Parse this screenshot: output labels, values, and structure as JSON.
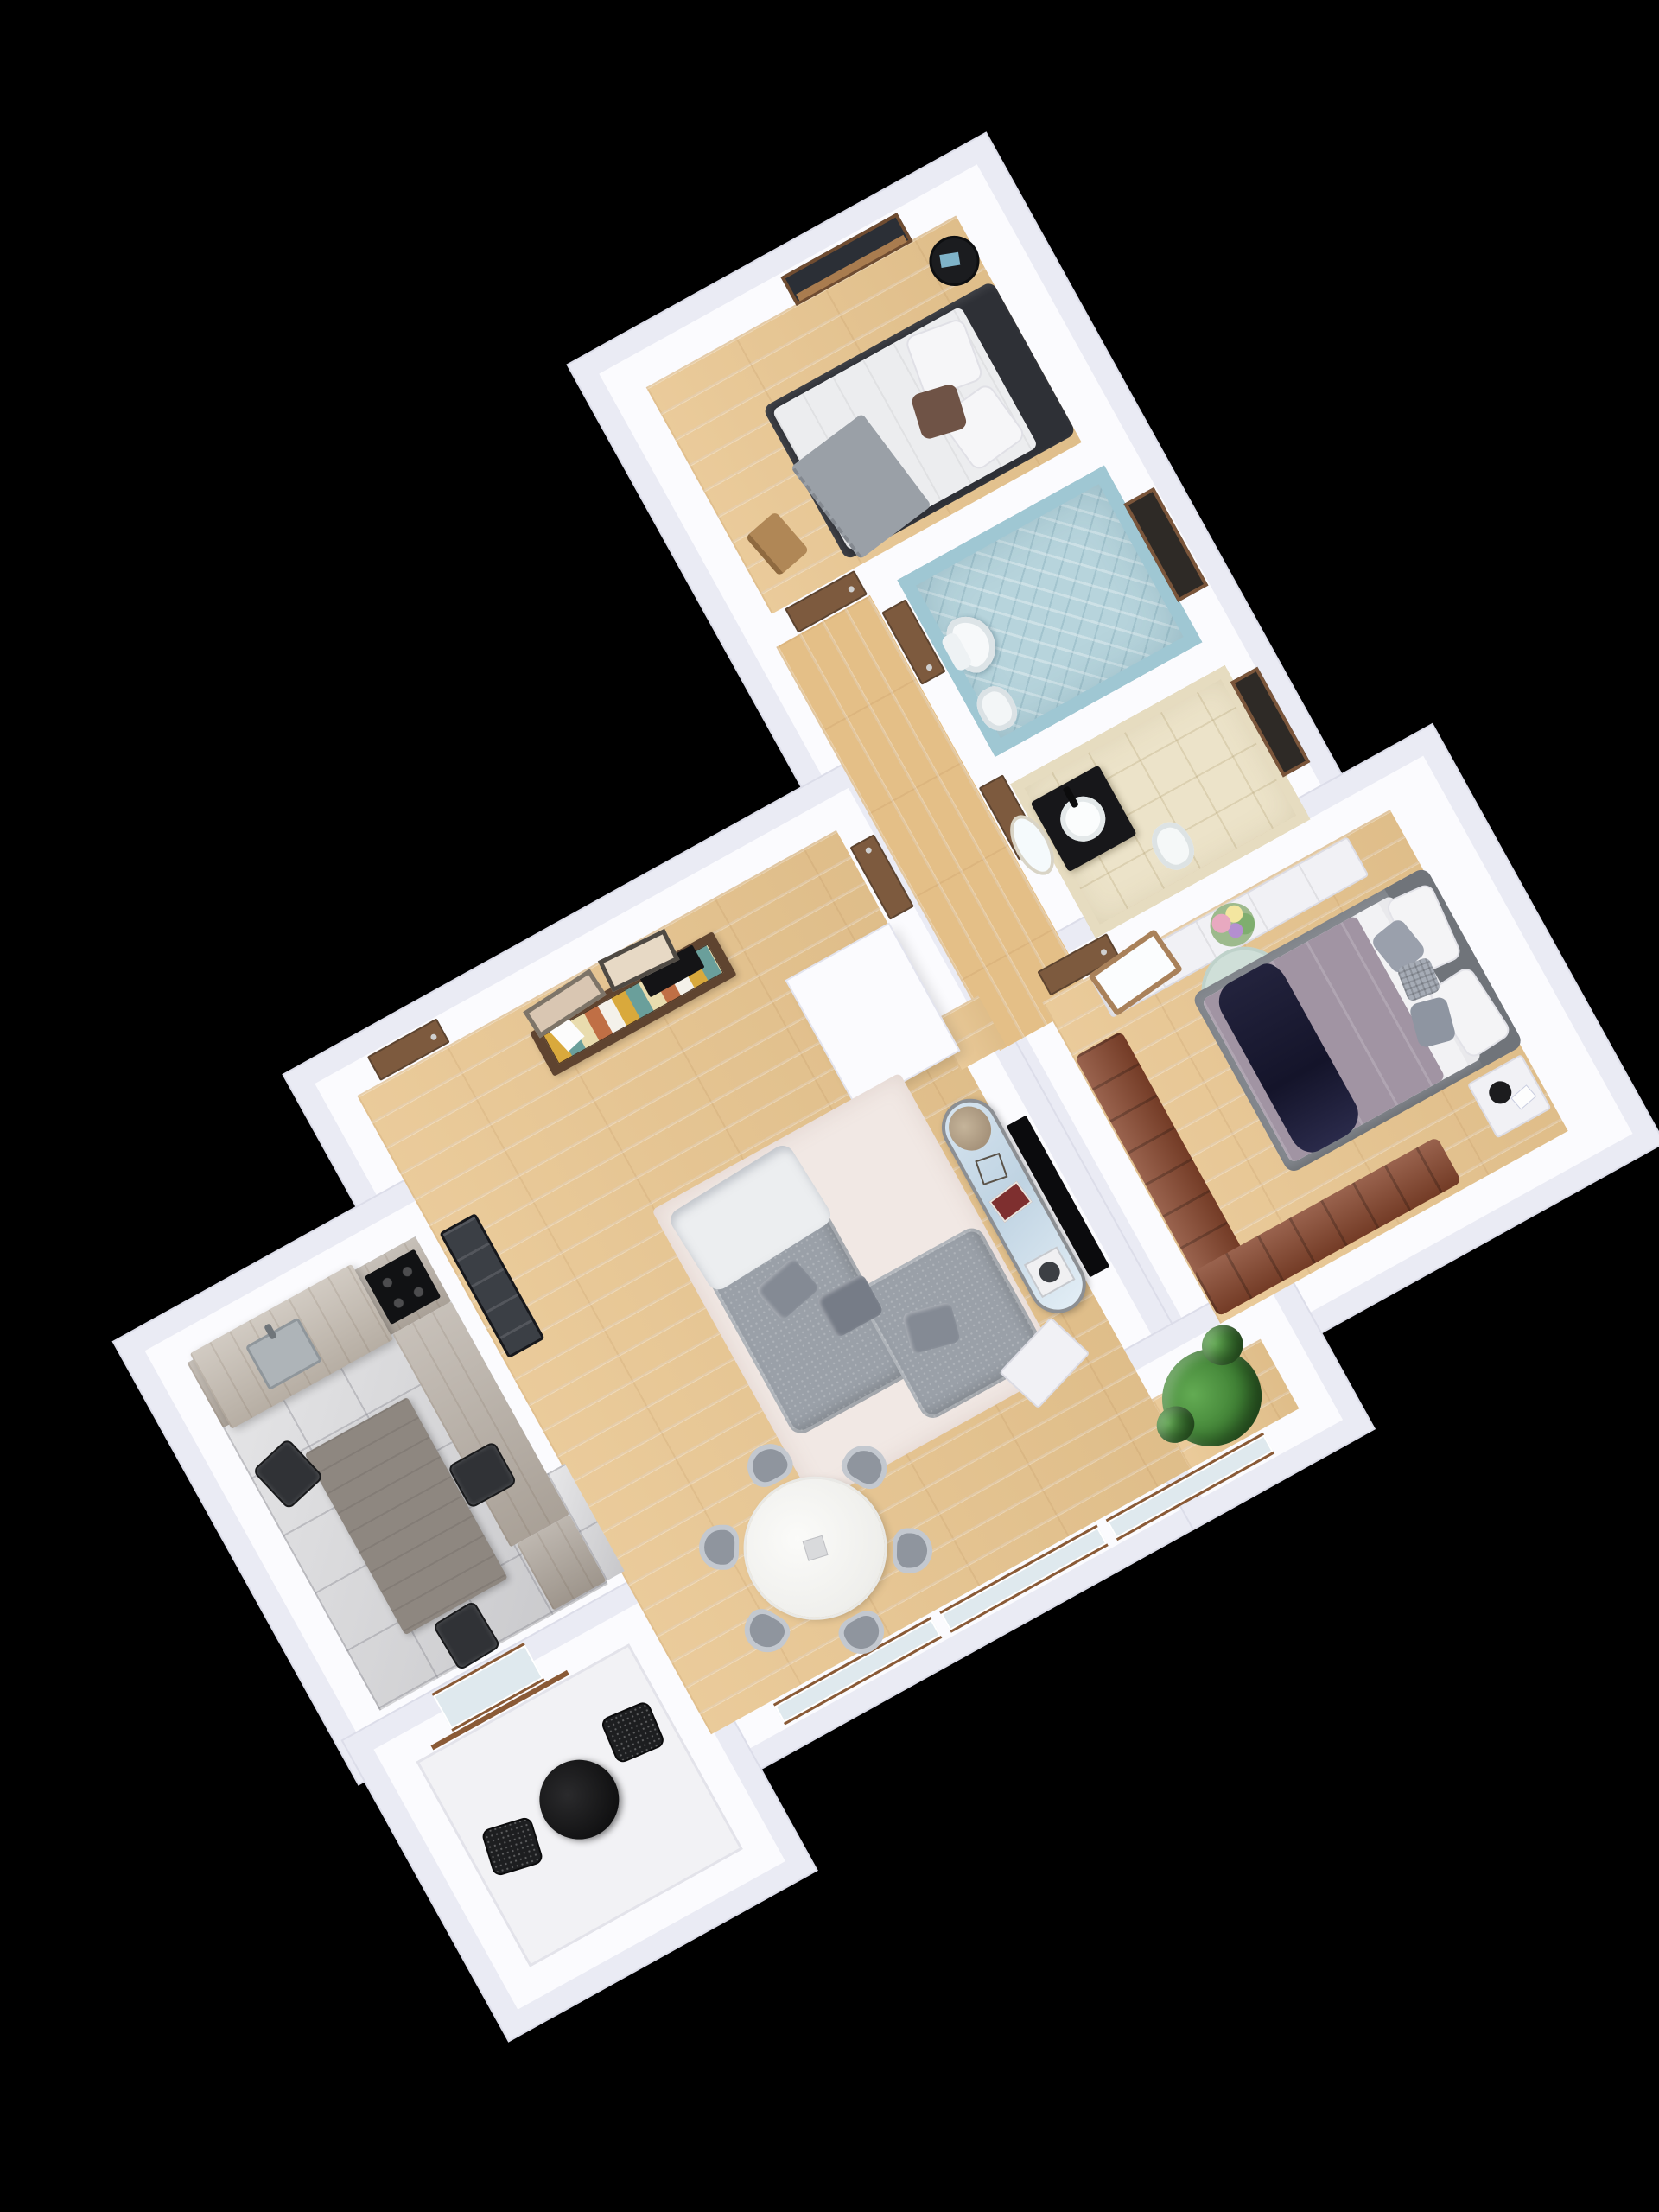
{
  "scene": {
    "title": "3D apartment floor plan render",
    "view": "top-down 3D cutaway on black background",
    "plan_rotation_deg": -29,
    "background_color": "#000000"
  },
  "palette": {
    "wall_top": "#fbfbfe",
    "wall_outer_face": "#eaebf4",
    "wood_floor": "#e8c58f",
    "kitchen_tile": "#d4d4d7",
    "wc_tile_blue": "#a6cbd6",
    "bathroom_tile_beige": "#ece3c9",
    "balcony_floor": "#f2f2f5",
    "door_wood": "#7d5a3e",
    "sofa_gray": "#9aa0a8",
    "rug_cream": "#f1e8e4",
    "leather_brown": "#86452c",
    "master_duvet_mauve": "#a194a3",
    "master_throw_navy": "#20203a",
    "bed2_frame_charcoal": "#2e3036",
    "kitchen_cabinet_gray_oak": "#b4aba1",
    "dining_table_marble": "#f4f4f2",
    "plant_green": "#3f8034",
    "console_walnut": "#5f4430",
    "drawer_accent_colors": [
      "#d9a93c",
      "#6a9f9b",
      "#e9dcae",
      "#c06f45",
      "#f4f1ea"
    ]
  },
  "rooms": {
    "bedroom2": {
      "name": "Bedroom 2",
      "items": [
        "double bed with white bedding",
        "charcoal bed frame and headboard",
        "gray fringed throw",
        "brown accent pillow",
        "two white pillows",
        "black round side table with book",
        "wooden chair",
        "window with wood sill",
        "oak parquet floor"
      ]
    },
    "hallway": {
      "name": "Hallway",
      "items": [
        "bedroom door",
        "WC door",
        "bathroom door",
        "closet door",
        "oak parquet floor"
      ]
    },
    "wc": {
      "name": "WC (blue bathroom)",
      "items": [
        "wall-hung toilet",
        "bidet",
        "blue herringbone wall tiles",
        "window with wood frame"
      ]
    },
    "bathroom": {
      "name": "Bathroom (beige)",
      "items": [
        "black vanity with white vessel sink",
        "oval mirror",
        "bidet",
        "beige stone tiles",
        "window with wood frame"
      ]
    },
    "master_bedroom": {
      "name": "Master Bedroom",
      "items": [
        "gray upholstered double bed",
        "mauve duvet",
        "dark navy satin throw",
        "white and gray pillows",
        "white dresser along north wall",
        "leaning vanity mirror with wood frame",
        "flower bouquet",
        "mint round rug with figurine",
        "white nightstand with alarm clock",
        "brown leather L-shaped bench sofa",
        "oak parquet floor"
      ]
    },
    "living_room": {
      "name": "Living Room",
      "items": [
        "gray fabric corner sofa",
        "cream area rug",
        "light gray blanket on sofa",
        "oval TV sideboard with glass top, turntable, magazines and dried flowers",
        "wall-mounted flat TV",
        "walnut console with multicolor drawers",
        "two framed artworks leaning on wall",
        "black ladder shelf",
        "white closet block",
        "white side table",
        "potted green plant",
        "entry door",
        "south glazing with brown sills",
        "oak parquet floor"
      ]
    },
    "dining_area": {
      "name": "Dining Area",
      "items": [
        "round white marble dining table",
        "six gray upholstered chairs"
      ]
    },
    "kitchen": {
      "name": "Kitchen",
      "items": [
        "L-shaped gray oak counter",
        "extractor canopy",
        "black induction cooktop",
        "stainless sink",
        "gray wood dining table",
        "three black chrome-leg chairs",
        "gray tile floor",
        "tall corner cabinet"
      ]
    },
    "balcony": {
      "name": "Balcony",
      "items": [
        "round black bistro table",
        "two black wire mesh chairs",
        "white deck floor",
        "glazed door with brown sill"
      ]
    },
    "entry": {
      "name": "Entry",
      "items": [
        "wooden entrance door in alcove"
      ]
    }
  }
}
